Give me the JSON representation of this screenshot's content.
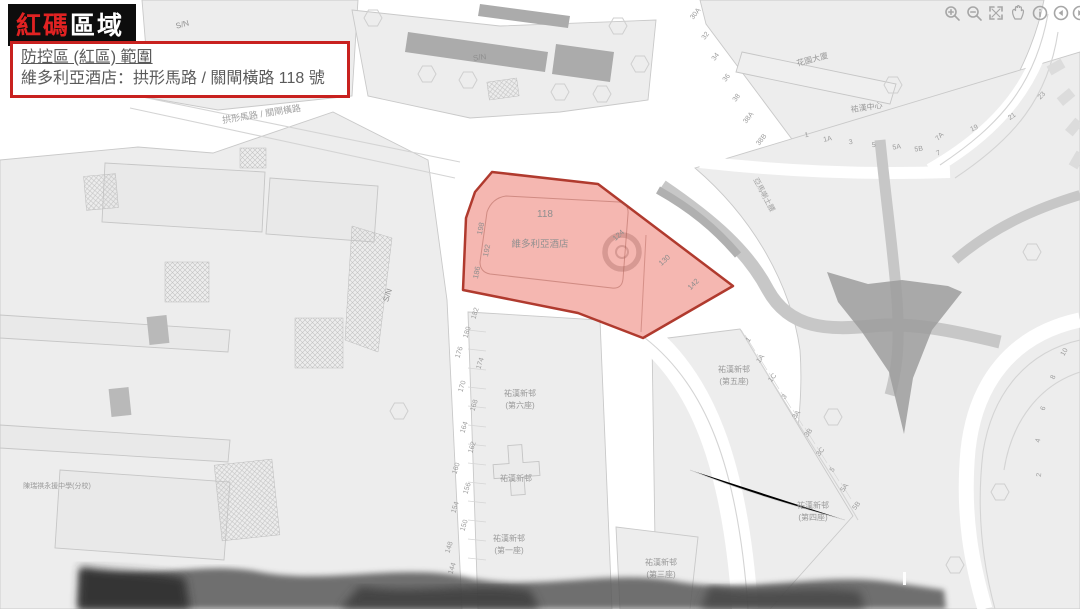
{
  "header": {
    "badge_red": "紅碼",
    "badge_white": "區域",
    "info_line1": "防控區 (紅區) 範圍",
    "info_line2": "維多利亞酒店：拱形馬路 / 關閘橫路 118 號"
  },
  "toolbar": {
    "icons": [
      "zoom-in",
      "zoom-out",
      "fullscreen",
      "pan-hand",
      "info",
      "previous-extent",
      "next-extent"
    ]
  },
  "colors": {
    "zone_fill": "#ec7063",
    "zone_border": "#b03a2e",
    "badge_bg": "#0d0d0d",
    "badge_red": "#e02222",
    "info_border": "#c8211f",
    "map_block": "#ededed",
    "map_line": "#c9c9c9"
  },
  "zone": {
    "number": "118",
    "hotel_name": "維多利亞酒店",
    "left_numbers": [
      "198",
      "192",
      "186"
    ],
    "right_numbers": [
      "124",
      "130",
      "142"
    ]
  },
  "roads": {
    "nw_label": "拱形馬路 / 關閘橫路",
    "ne_label": "亞馬喇土腰"
  },
  "labels": {
    "sn": [
      "S/N",
      "S/N",
      "S/N"
    ],
    "school": "陳瑞祺永援中學(分校)",
    "garden_building": "花園大廈",
    "center_building": "祐漢中心"
  },
  "blocks": [
    {
      "name": "祐漢新邨",
      "unit": "(第六座)"
    },
    {
      "name": "祐漢新邨",
      "unit": ""
    },
    {
      "name": "祐漢新邨",
      "unit": "(第一座)"
    },
    {
      "name": "祐漢新邨",
      "unit": "(第三座)"
    },
    {
      "name": "祐漢新邨",
      "unit": "(第五座)"
    },
    {
      "name": "祐漢新邨",
      "unit": "(第四座)"
    }
  ],
  "street_numbers": {
    "west": [
      "182",
      "180",
      "176",
      "174",
      "170",
      "168",
      "164",
      "162",
      "160",
      "156",
      "154",
      "150",
      "148",
      "144"
    ],
    "tr_diag": [
      "30A",
      "32",
      "34",
      "36",
      "38",
      "38A",
      "38B"
    ],
    "tr_bottom": [
      "1",
      "1A",
      "3",
      "5",
      "5A",
      "5B",
      "7"
    ],
    "tr_curve": [
      "7A",
      "19",
      "21",
      "23"
    ],
    "se_diag": [
      "1",
      "1A",
      "1C",
      "3",
      "3A",
      "3B",
      "3C",
      "5",
      "5A",
      "5B"
    ],
    "right_curve": [
      "10",
      "8",
      "6",
      "4",
      "2"
    ]
  }
}
